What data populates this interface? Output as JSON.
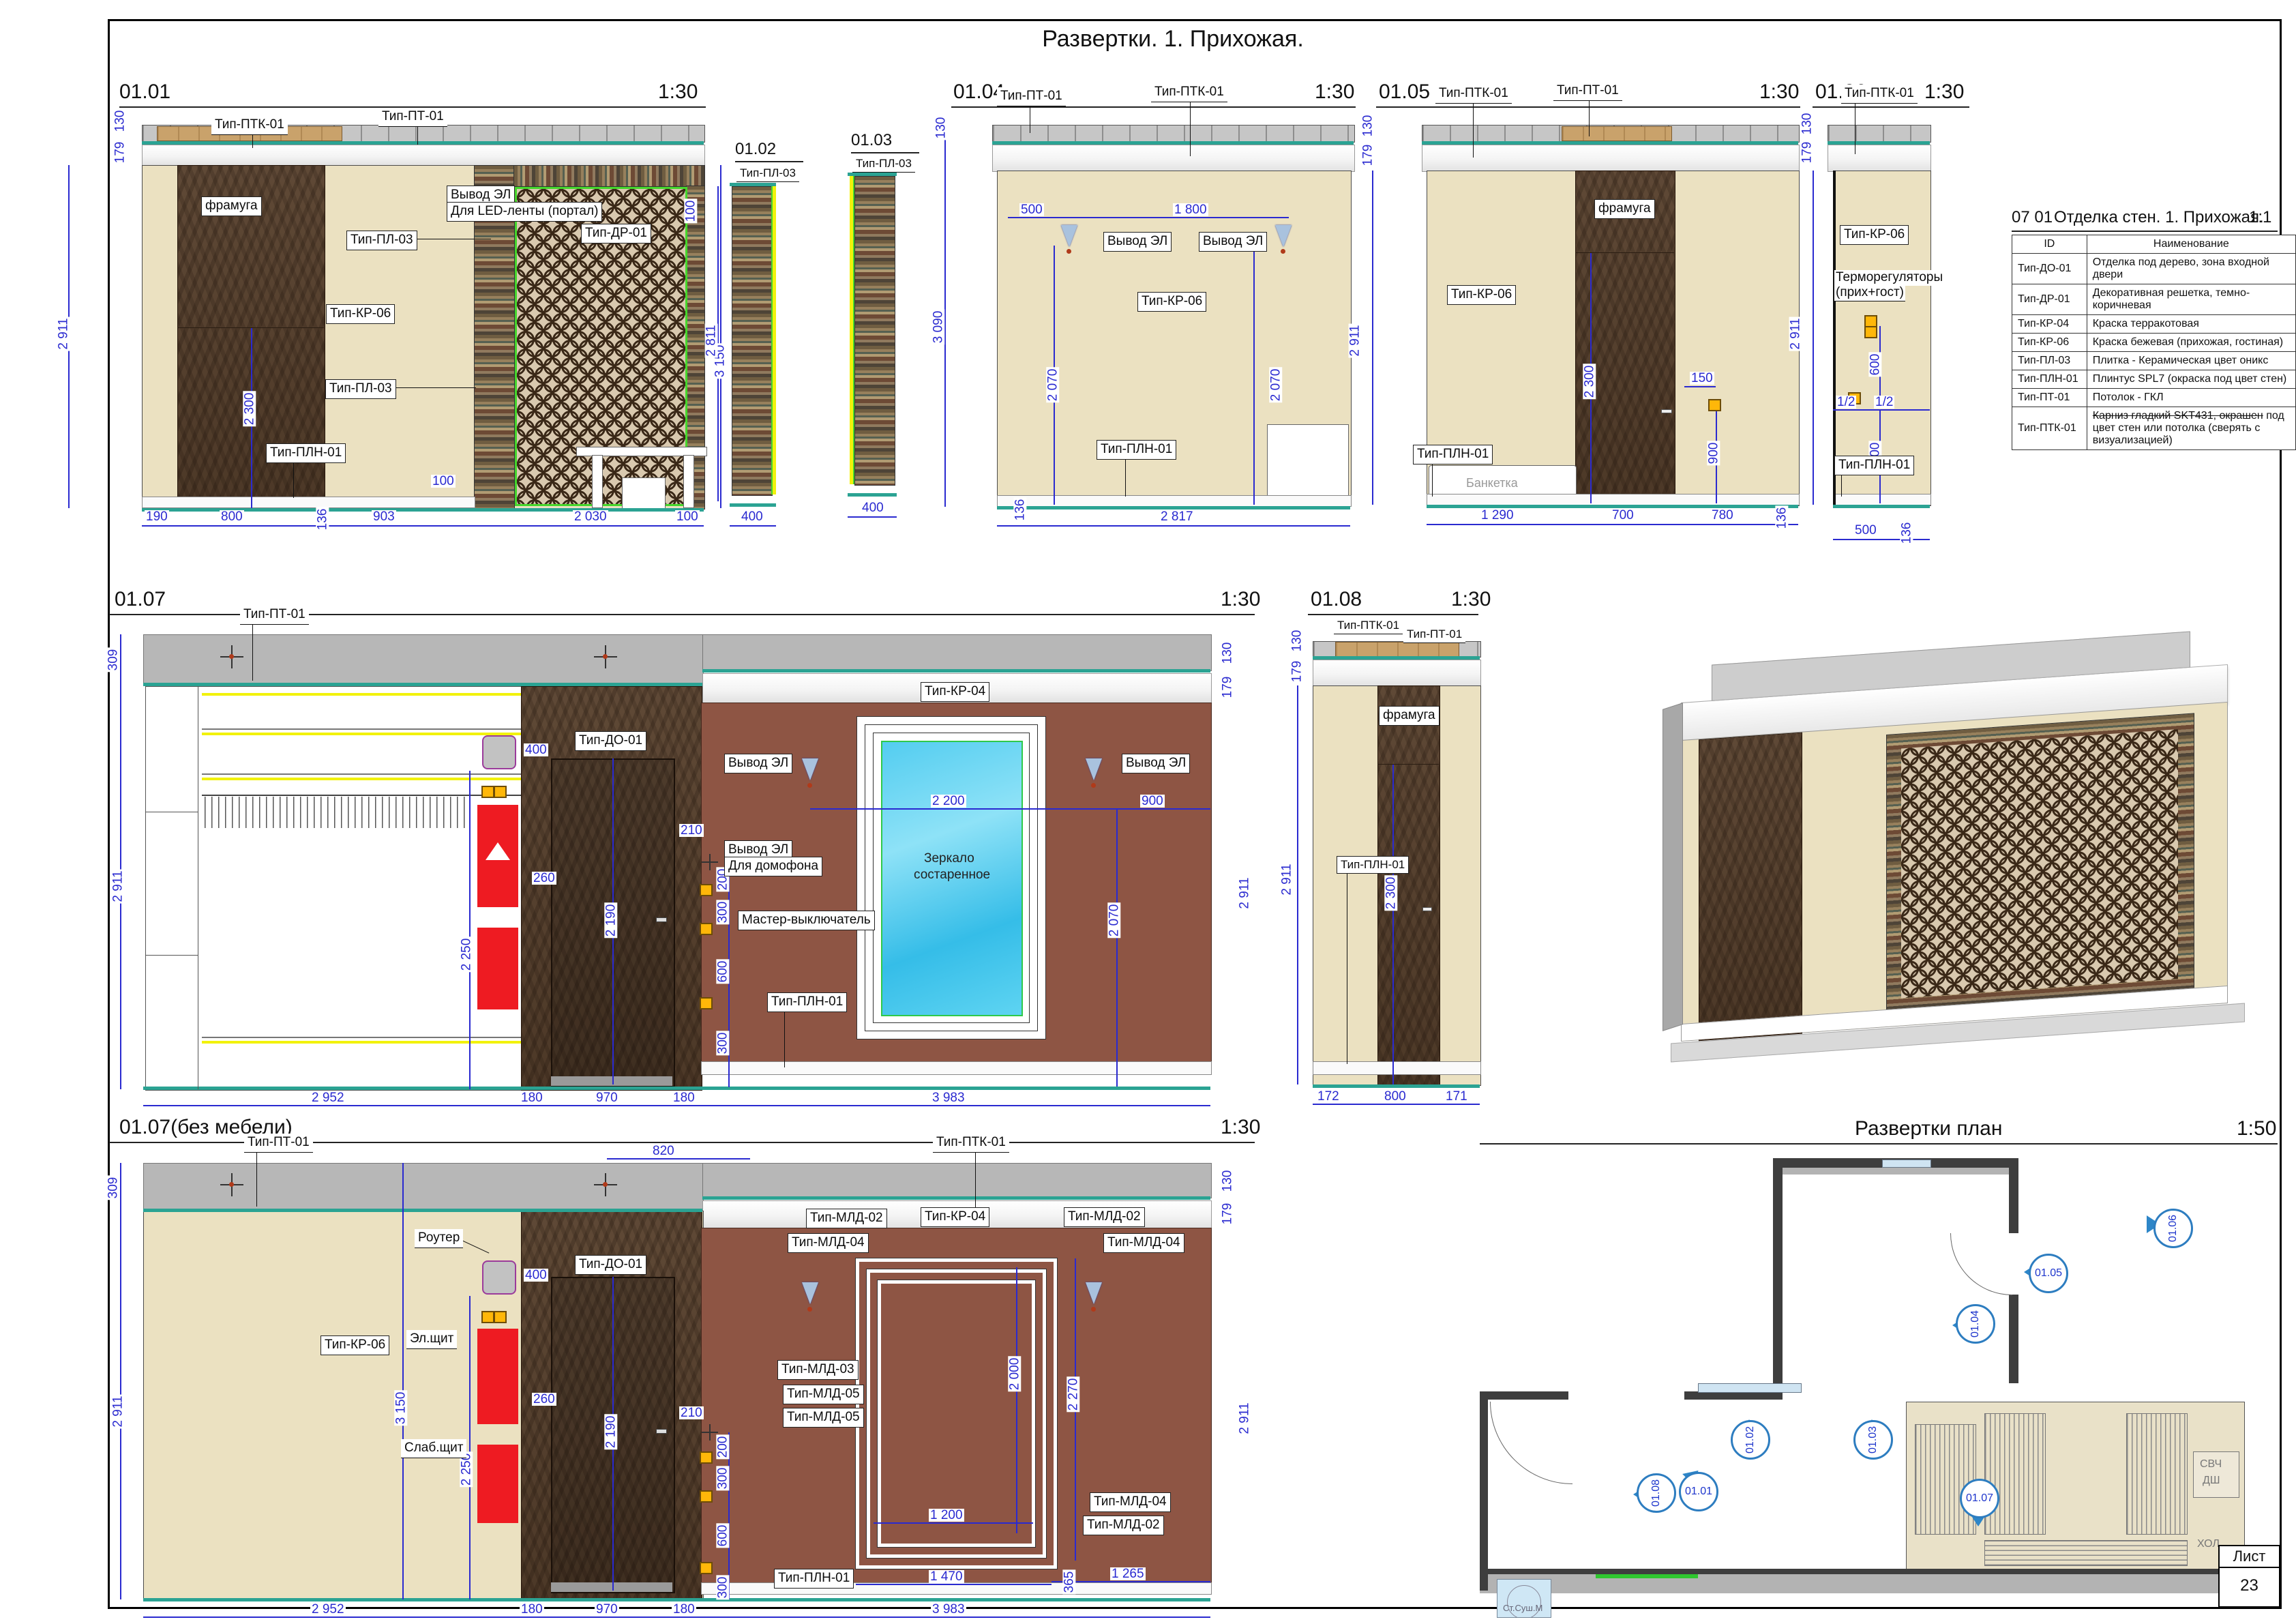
{
  "sheet": {
    "title": "Развертки. 1. Прихожая.",
    "list_label": "Лист",
    "sheet_number": "23"
  },
  "legend": {
    "code": "07 01",
    "title": "Отделка стен. 1. Прихожая.",
    "scale": "1:1",
    "col_id": "ID",
    "col_name": "Наименование",
    "ids": [
      "Тип-ДО-01",
      "Тип-ДР-01",
      "Тип-КР-04",
      "Тип-КР-06",
      "Тип-ПЛ-03",
      "Тип-ПЛН-01",
      "Тип-ПТ-01",
      "Тип-ПТК-01"
    ],
    "names": [
      "Отделка под дерево, зона входной двери",
      "Декоративная решетка, темно-коричневая",
      "Краска терракотовая",
      "Краска бежевая (прихожая, гостиная)",
      "Плитка - Керамическая цвет оникс",
      "Плинтус SPL7 (окраска под цвет стен)",
      "Потолок - ГКЛ"
    ],
    "name8_strike": "Карниз гладкий SKT431, окрашен",
    "name8_rest": "под цвет стен или потолка (сверять с визуализацией)"
  },
  "e1": {
    "id": "01.01",
    "scale": "1:30",
    "ptk": "Тип-ПТК-01",
    "pt": "Тип-ПТ-01",
    "pl03a": "Тип-ПЛ-03",
    "framuga": "фрамуга",
    "kr06": "Тип-КР-06",
    "pl03b": "Тип-ПЛ-03",
    "pln": "Тип-ПЛН-01",
    "dr01": "Тип-ДР-01",
    "led1": "Вывод ЭЛ",
    "led2": "Для LED-ленты (портал)",
    "d130": "130",
    "d179": "179",
    "v2911": "2 911",
    "v2300": "2 300",
    "r100": "100",
    "r3150": "3 150",
    "mid100": "100",
    "b190": "190",
    "b800": "800",
    "b136": "136",
    "b903": "903",
    "b2030": "2 030",
    "b100": "100"
  },
  "e2": {
    "id": "01.02",
    "pl03": "Тип-ПЛ-03",
    "v2811": "2 811",
    "b400": "400"
  },
  "e3": {
    "id": "01.03",
    "pl03": "Тип-ПЛ-03",
    "b400": "400"
  },
  "e4": {
    "id": "01.04",
    "scale": "1:30",
    "pt": "Тип-ПТ-01",
    "ptk": "Тип-ПТК-01",
    "kr06": "Тип-КР-06",
    "pln": "Тип-ПЛН-01",
    "vyvod1": "Вывод ЭЛ",
    "vyvod2": "Вывод ЭЛ",
    "d130": "130",
    "v3090": "3 090",
    "t500": "500",
    "t1800": "1 800",
    "v2070a": "2 070",
    "v2070b": "2 070",
    "b136": "136",
    "b2817": "2 817"
  },
  "e5": {
    "id": "01.05",
    "scale": "1:30",
    "ptk": "Тип-ПТК-01",
    "pt": "Тип-ПТ-01",
    "framuga": "фрамуга",
    "kr06": "Тип-КР-06",
    "pln": "Тип-ПЛН-01",
    "banketka": "Банкетка",
    "d130": "130",
    "d179": "179",
    "v2911": "2 911",
    "v2300": "2 300",
    "d150": "150",
    "v900": "900",
    "b1290": "1 290",
    "b700": "700",
    "b780": "780",
    "b136": "136"
  },
  "e6": {
    "id": "01.06",
    "scale": "1:30",
    "ptk": "Тип-ПТК-01",
    "kr06": "Тип-КР-06",
    "thermo1": "Терморегуляторы",
    "thermo2": "(прих+гост)",
    "pln": "Тип-ПЛН-01",
    "d130": "130",
    "d179": "179",
    "v2911": "2 911",
    "v600": "600",
    "half1": "1/2",
    "half2": "1/2",
    "v900": "900",
    "b500": "500",
    "b136": "136"
  },
  "e7": {
    "id": "01.07",
    "scale": "1:30",
    "pt": "Тип-ПТ-01",
    "do01": "Тип-ДО-01",
    "kr04": "Тип-КР-04",
    "mirror1": "Зеркало",
    "mirror2": "состаренное",
    "vyvodL": "Вывод ЭЛ",
    "vyvodR": "Вывод ЭЛ",
    "domofon1": "Вывод ЭЛ",
    "domofon2": "Для домофона",
    "master": "Мастер-выключатель",
    "pln": "Тип-ПЛН-01",
    "d309": "309",
    "v2911L": "2 911",
    "v2250": "2 250",
    "d400": "400",
    "d260": "260",
    "d210": "210",
    "v2190": "2 190",
    "c200": "200",
    "c300": "300",
    "c600": "600",
    "c300b": "300",
    "d2200": "2 200",
    "d900": "900",
    "v2070": "2 070",
    "r130": "130",
    "r179": "179",
    "r2911": "2 911",
    "b2952": "2 952",
    "b180a": "180",
    "b970": "970",
    "b180b": "180",
    "b3983": "3 983"
  },
  "e8": {
    "id": "01.08",
    "scale": "1:30",
    "ptk": "Тип-ПТК-01",
    "pt": "Тип-ПТ-01",
    "framuga": "фрамуга",
    "pln": "Тип-ПЛН-01",
    "d130": "130",
    "d179": "179",
    "v2911": "2 911",
    "v2300": "2 300",
    "b172": "172",
    "b800": "800",
    "b171": "171"
  },
  "e9": {
    "id": "01.07(без мебели)",
    "scale": "1:30",
    "pt": "Тип-ПТ-01",
    "ptk": "Тип-ПТК-01",
    "router": "Роутер",
    "el": "Эл.щит",
    "slab": "Слаб.щит",
    "kr06": "Тип-КР-06",
    "do01": "Тип-ДО-01",
    "kr04": "Тип-КР-04",
    "mld02a": "Тип-МЛД-02",
    "mld04a": "Тип-МЛД-04",
    "mld02b": "Тип-МЛД-02",
    "mld04b": "Тип-МЛД-04",
    "mld03": "Тип-МЛД-03",
    "mld05a": "Тип-МЛД-05",
    "mld05b": "Тип-МЛД-05",
    "mld04c": "Тип-МЛД-04",
    "mld02c": "Тип-МЛД-02",
    "pln": "Тип-ПЛН-01",
    "d309": "309",
    "v2911L": "2 911",
    "d820": "820",
    "d400": "400",
    "d260": "260",
    "d210": "210",
    "v3150": "3 150",
    "v2250": "2 250",
    "v2190": "2 190",
    "c200": "200",
    "c300": "300",
    "c600": "600",
    "c300b": "300",
    "v2000": "2 000",
    "v2270": "2 270",
    "d1200": "1 200",
    "d1470": "1 470",
    "d365": "365",
    "d1265": "1 265",
    "r130": "130",
    "r179": "179",
    "r2911": "2 911",
    "b2952": "2 952",
    "b180a": "180",
    "b970": "970",
    "b180b": "180",
    "b3983": "3 983"
  },
  "plan": {
    "title": "Развертки план",
    "scale": "1:50",
    "m0101": "01.01",
    "m0102": "01.02",
    "m0103": "01.03",
    "m0104": "01.04",
    "m0105": "01.05",
    "m0106": "01.06",
    "m0107": "01.07",
    "m0108": "01.08",
    "svch": "СВЧ",
    "dsh": "ДШ",
    "hol": "ХОЛ",
    "washer": "Ст.Суш.М"
  }
}
